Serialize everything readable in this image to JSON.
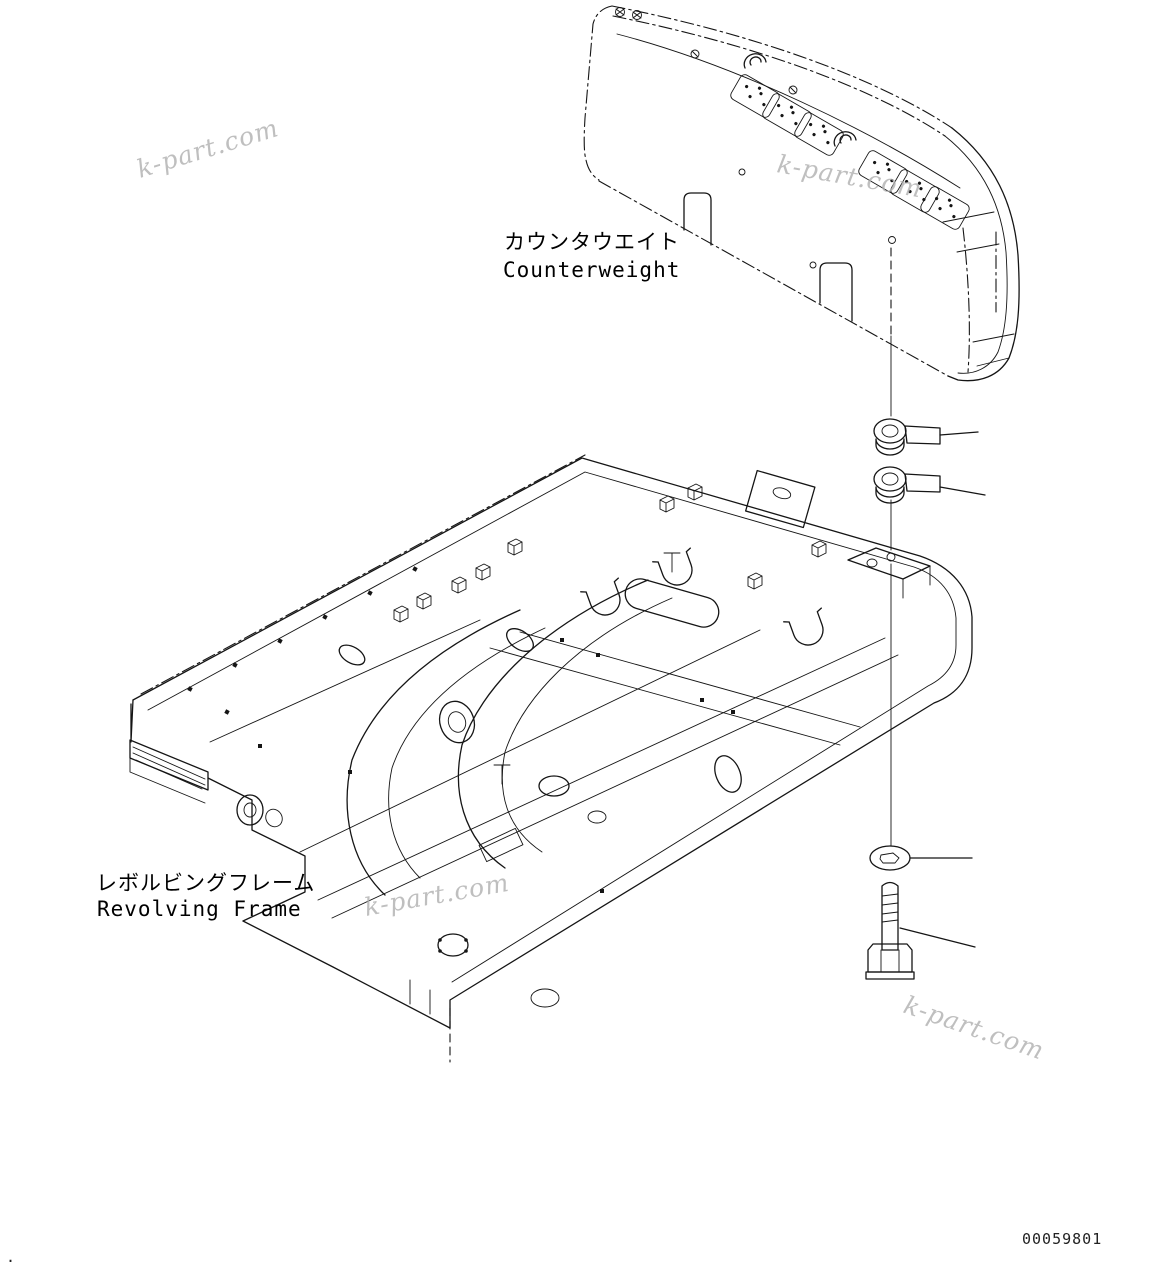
{
  "diagram": {
    "labels": {
      "counterweight": {
        "jp": "カウンタウエイト",
        "en": "Counterweight"
      },
      "revolving_frame": {
        "jp": "レボルビングフレーム",
        "en": "Revolving Frame"
      }
    },
    "drawing_number": "00059801",
    "page_mark": ".",
    "watermark": {
      "text": "k-part.com",
      "color": "#b0b0b0"
    },
    "colors": {
      "line": "#151515",
      "background": "#ffffff"
    }
  }
}
